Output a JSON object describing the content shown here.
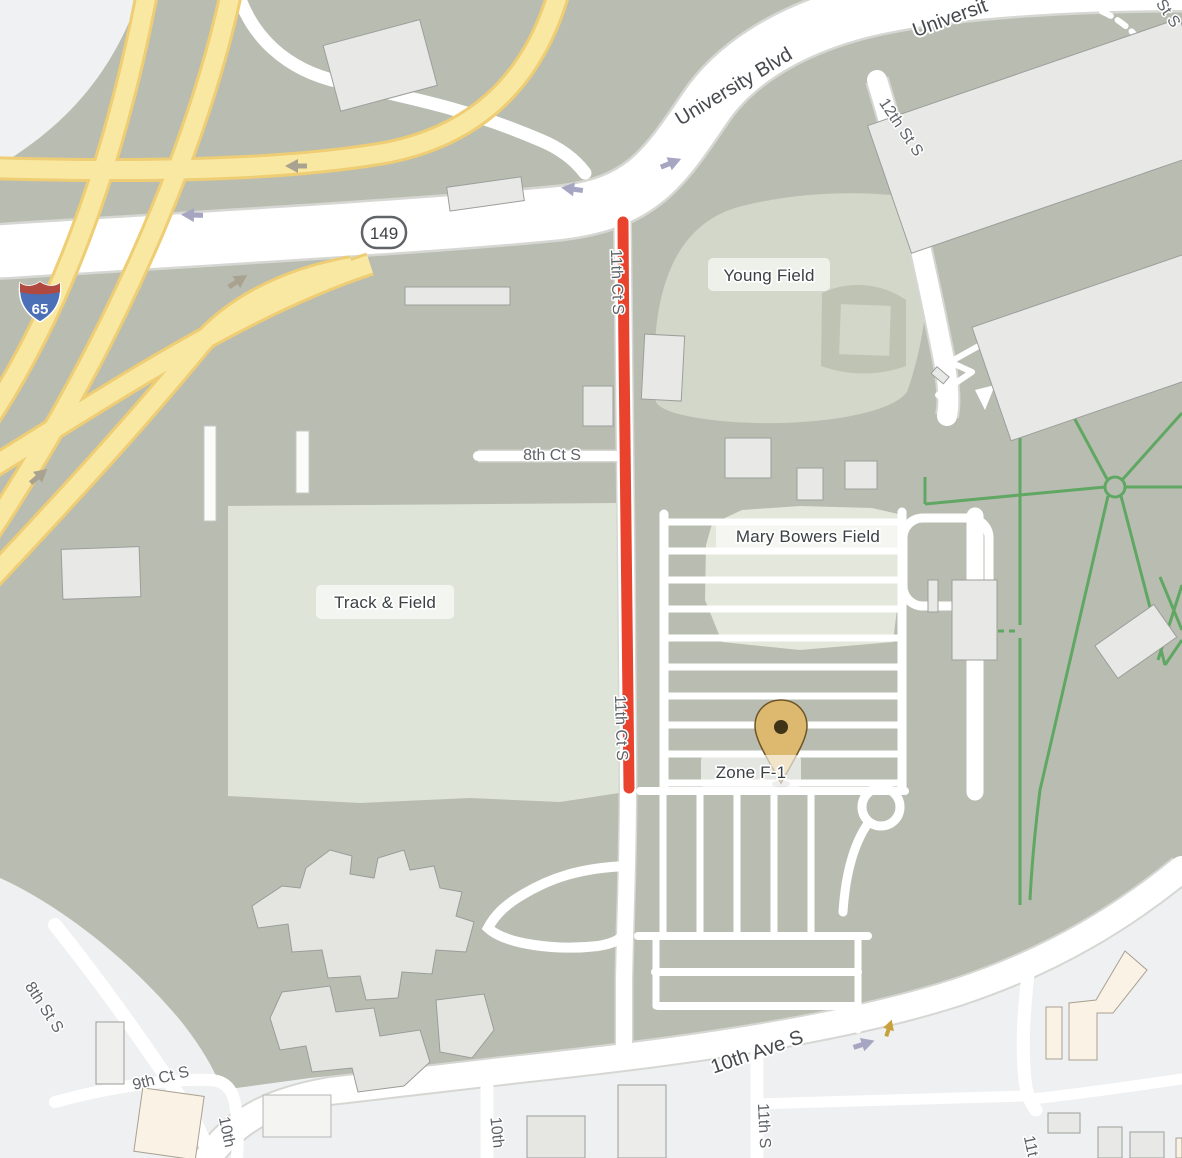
{
  "map": {
    "streets": {
      "university_blvd": "University Blvd",
      "university_blvd_partial": "Universit",
      "twelfth_st_s": "12th St S",
      "partial_st_s": "St S",
      "eighth_ct_s": "8th Ct S",
      "eleventh_ct_s": "11th Ct S",
      "tenth_ave_s": "10th Ave S",
      "eighth_st_s": "8th St S",
      "ninth_ct_s": "9th Ct S",
      "tenth_partial_left": "10th",
      "tenth_partial_mid": "10th",
      "eleventh_partial_mid": "11th S",
      "eleventh_partial_right": "11t"
    },
    "places": {
      "young_field": "Young Field",
      "track_and_field": "Track & Field",
      "mary_bowers_field": "Mary Bowers Field"
    },
    "marker": {
      "label": "Zone F-1"
    },
    "route_badges": {
      "state_route": "149",
      "interstate": "65"
    },
    "colors": {
      "land": "#b9bdb1",
      "urban_light": "#eef0f1",
      "road_white": "#ffffff",
      "track_field_green": "#dfe4d8",
      "ballfield_light": "#d3d7c9",
      "infield_gray": "#bfc3b4",
      "mary_bowers_light": "#e4e7db",
      "building_gray": "#e8e9e6",
      "building_beige": "#faf2e5",
      "highway_yellow": "#f9e8a2",
      "highway_casing": "#eecd74",
      "closure_red": "#e9432e",
      "path_green": "#5fa763",
      "marker_fill": "#dcb96e",
      "marker_dot": "#3f3318",
      "shield_blue": "#4b70b8",
      "shield_red": "#b04a40"
    }
  }
}
